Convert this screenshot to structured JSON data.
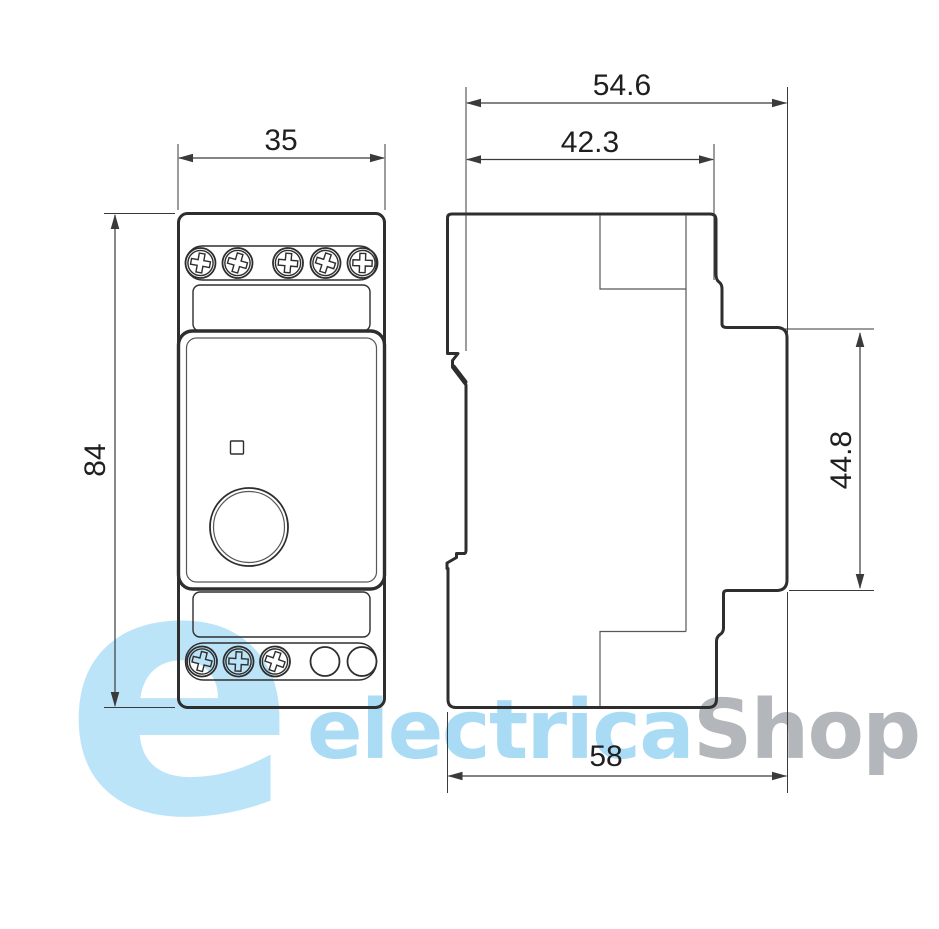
{
  "watermark": {
    "logo_glyph": "e",
    "brand_light": "electrica",
    "brand_dark": "Shop",
    "logo_blue": "#bce4f8",
    "light_blue": "#a9dbf5",
    "gray": "#b3b6ba"
  },
  "dimensions": {
    "front_width_mm": "35",
    "front_height_mm": "84",
    "side_overall_depth_mm": "54.6",
    "side_body_depth_mm": "42.3",
    "side_front_height_mm": "44.8",
    "side_overall_width_mm": "58"
  },
  "theme": {
    "background": "#ffffff",
    "line_color": "#2e2e2e",
    "thin_line_color": "#55585b",
    "dim_color": "#3a3a3a",
    "text_color": "#1f1f1f"
  }
}
